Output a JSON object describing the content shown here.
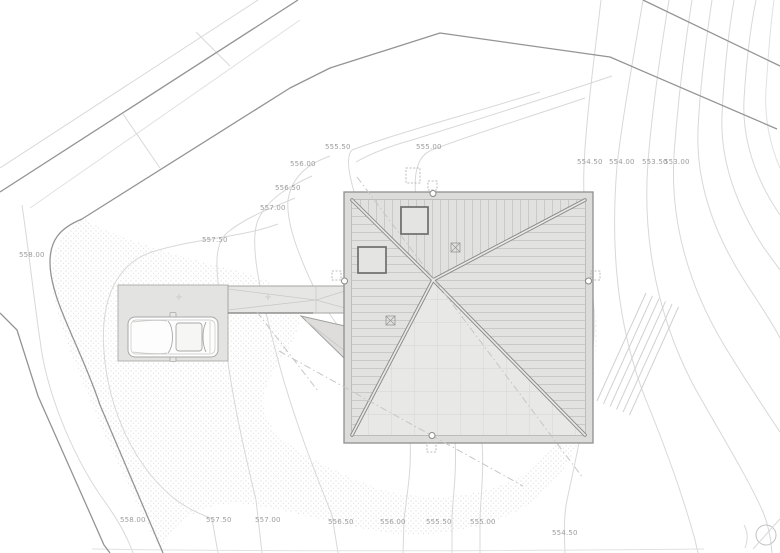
{
  "drawing": {
    "kind": "architectural-site-plan-roof-level",
    "colors": {
      "label": "#9c9c9c",
      "contour": "#d8d8d8",
      "boundary": "#949494",
      "roof_fill": "#e2e2e0",
      "roof_band": "#dcdcda",
      "gravel_dot": "#c7c7c7",
      "slab_fill": "#e3e3e1"
    },
    "contour_labels": [
      {
        "text": "555.50",
        "x": 325,
        "y": 143
      },
      {
        "text": "555.00",
        "x": 416,
        "y": 143
      },
      {
        "text": "554.50",
        "x": 577,
        "y": 158
      },
      {
        "text": "554.00",
        "x": 609,
        "y": 158
      },
      {
        "text": "553.50",
        "x": 642,
        "y": 158
      },
      {
        "text": "553.00",
        "x": 664,
        "y": 158
      },
      {
        "text": "556.00",
        "x": 290,
        "y": 160
      },
      {
        "text": "556.50",
        "x": 275,
        "y": 184
      },
      {
        "text": "557.00",
        "x": 260,
        "y": 204
      },
      {
        "text": "557.50",
        "x": 202,
        "y": 236
      },
      {
        "text": "558.00",
        "x": 19,
        "y": 251
      },
      {
        "text": "558.00",
        "x": 120,
        "y": 516
      },
      {
        "text": "557.50",
        "x": 206,
        "y": 516
      },
      {
        "text": "557.00",
        "x": 255,
        "y": 516
      },
      {
        "text": "556.50",
        "x": 328,
        "y": 518
      },
      {
        "text": "556.00",
        "x": 380,
        "y": 518
      },
      {
        "text": "555.50",
        "x": 426,
        "y": 518
      },
      {
        "text": "555.00",
        "x": 470,
        "y": 518
      },
      {
        "text": "554.50",
        "x": 552,
        "y": 529
      }
    ]
  }
}
